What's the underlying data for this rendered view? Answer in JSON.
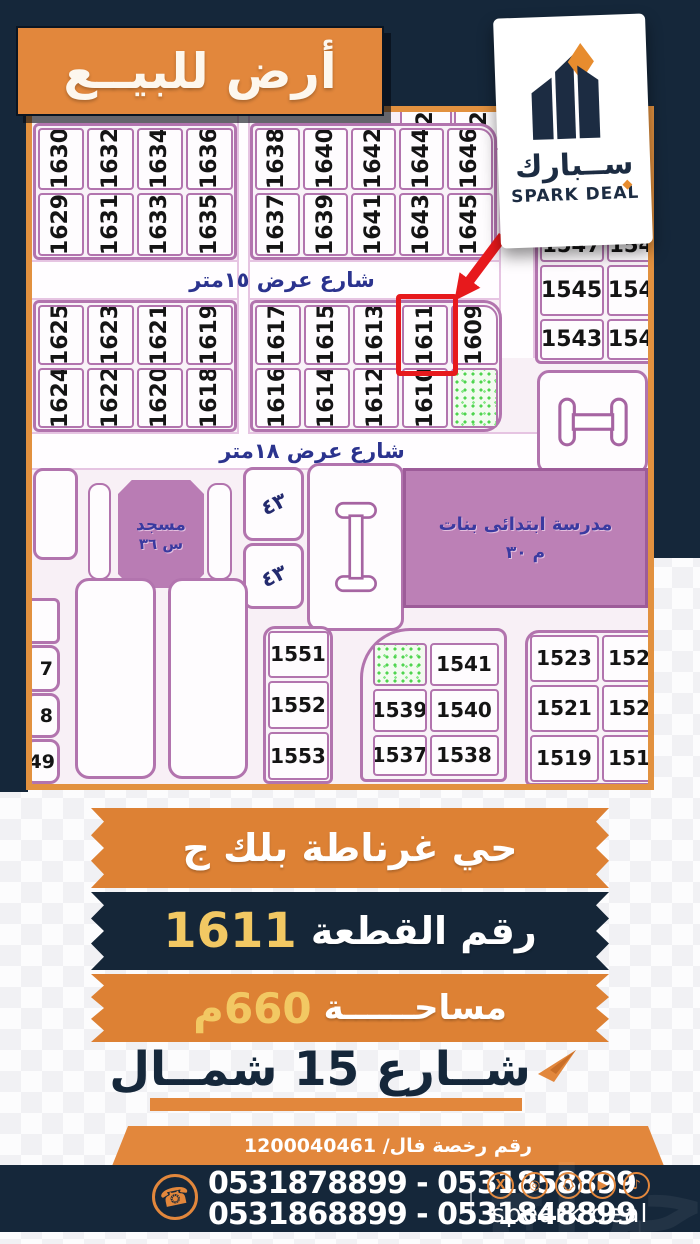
{
  "header": {
    "title": "أرض للبيــع"
  },
  "logo": {
    "arabic": "ســبارك",
    "english": "SPARK DEAL"
  },
  "map": {
    "street_15": "شارع عرض ١٥متر",
    "street_18": "شارع عرض ١٨متر",
    "partial_top": [
      "12",
      "12"
    ],
    "block_a": {
      "row1": [
        "1630",
        "1632",
        "1634",
        "1636"
      ],
      "row2": [
        "1629",
        "1631",
        "1633",
        "1635"
      ]
    },
    "block_b": {
      "row1": [
        "1638",
        "1640",
        "1642",
        "1644",
        "1646"
      ],
      "row2": [
        "1637",
        "1639",
        "1641",
        "1643",
        "1645"
      ]
    },
    "block_c": {
      "row1": [
        "1625",
        "1623",
        "1621",
        "1619"
      ],
      "row2": [
        "1624",
        "1622",
        "1620",
        "1618"
      ]
    },
    "block_d": {
      "row1": [
        "1617",
        "1615",
        "1613",
        "1611",
        "1609"
      ],
      "row2": [
        "1616",
        "1614",
        "1612",
        "1610"
      ]
    },
    "right_grid": {
      "row0": [
        "1547",
        "1546"
      ],
      "row1": [
        "1545",
        "1544"
      ],
      "row2": [
        "1543",
        "1542"
      ]
    },
    "mosque_line1": "مسجد",
    "mosque_line2": "س ٣٦",
    "school_line1": "مدرسة ابتدائى بنات",
    "school_line2": "م ٣٠",
    "note_cell_1": "٤٣",
    "note_cell_2": "٤٣",
    "left_col": [
      "7",
      "8",
      "49"
    ],
    "col_1551": [
      "1551",
      "1552",
      "1553"
    ],
    "grid_1541": {
      "row1": [
        "1541"
      ],
      "row2": [
        "1539",
        "1540"
      ],
      "row3": [
        "1537",
        "1538"
      ]
    },
    "grid_1523": {
      "row1": [
        "1523",
        "1522"
      ],
      "row2": [
        "1521",
        "1520"
      ],
      "row3": [
        "1519",
        "1518"
      ]
    },
    "highlighted_plot": "1611"
  },
  "info": {
    "district": "حي غرناطة بلك ج",
    "plot_label": "رقم القطعة",
    "plot_number": "1611",
    "area_label": "مساحــــــة",
    "area_value": "660م",
    "street_direction": "شــارع 15 شمــال",
    "license": "رقم رخصة فال/  1200040461"
  },
  "footer": {
    "phone_line1": "0531878899 - 0531858899",
    "phone_line2": "0531868899 - 0531848899",
    "brand": "speark deal",
    "watermark": "حراج"
  },
  "colors": {
    "orange": "#e2873c",
    "navy": "#15273a",
    "gold": "#f2c863",
    "red": "#e7191c",
    "plot_border": "#b274ae",
    "green": "#4ed44e"
  }
}
